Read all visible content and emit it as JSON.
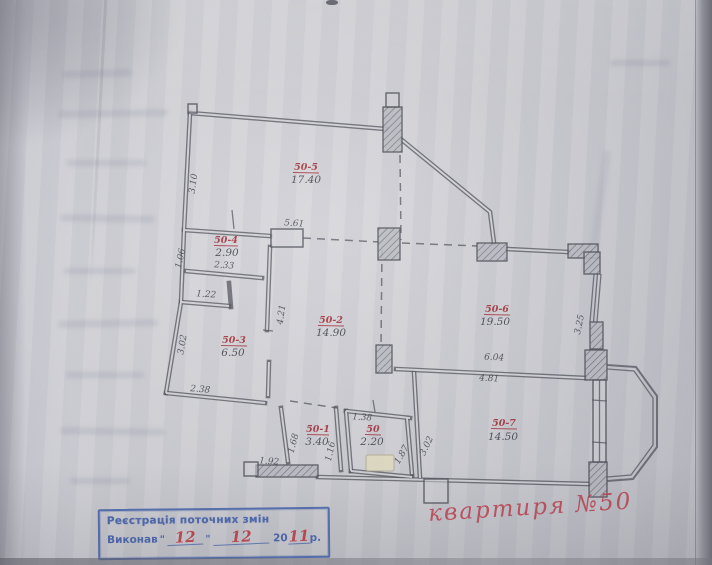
{
  "colors": {
    "paper": "#d4d4d9",
    "pencil": "#3e3e4a",
    "red_ink": "#a33138",
    "caption_red": "#c1414e",
    "stamp_blue": "#3e5eab"
  },
  "plan": {
    "rooms": [
      {
        "code": "50-5",
        "area": "17.40"
      },
      {
        "code": "50-4",
        "area": "2.90"
      },
      {
        "code": "50-3",
        "area": "6.50"
      },
      {
        "code": "50-2",
        "area": "14.90"
      },
      {
        "code": "50-6",
        "area": "19.50"
      },
      {
        "code": "50-7",
        "area": "14.50"
      },
      {
        "code": "50-1",
        "area": "3.40"
      },
      {
        "code": "50",
        "area": "2.20"
      }
    ],
    "dimensions": {
      "d3_10": "3.10",
      "d5_61": "5.61",
      "d1_06": "1.06",
      "d2_33": "2.33",
      "d1_22": "1.22",
      "d3_02a": "3.02",
      "d2_38": "2.38",
      "d4_21": "4.21",
      "d6_04": "6.04",
      "d4_81": "4.81",
      "d3_25": "3.25",
      "d3_02b": "3.02",
      "d1_68": "1.68",
      "d1_92": "1.92",
      "d1_16": "1.16",
      "d1_38": "1.38",
      "d1_87": "1.87"
    },
    "caption": "квартиря  №50"
  },
  "stamp": {
    "title": "Реєстрація поточних змін",
    "label": "Виконав",
    "quote": "\"",
    "day": "12",
    "month": "12",
    "year_prefix": "20",
    "year": "11",
    "suffix": "р."
  }
}
